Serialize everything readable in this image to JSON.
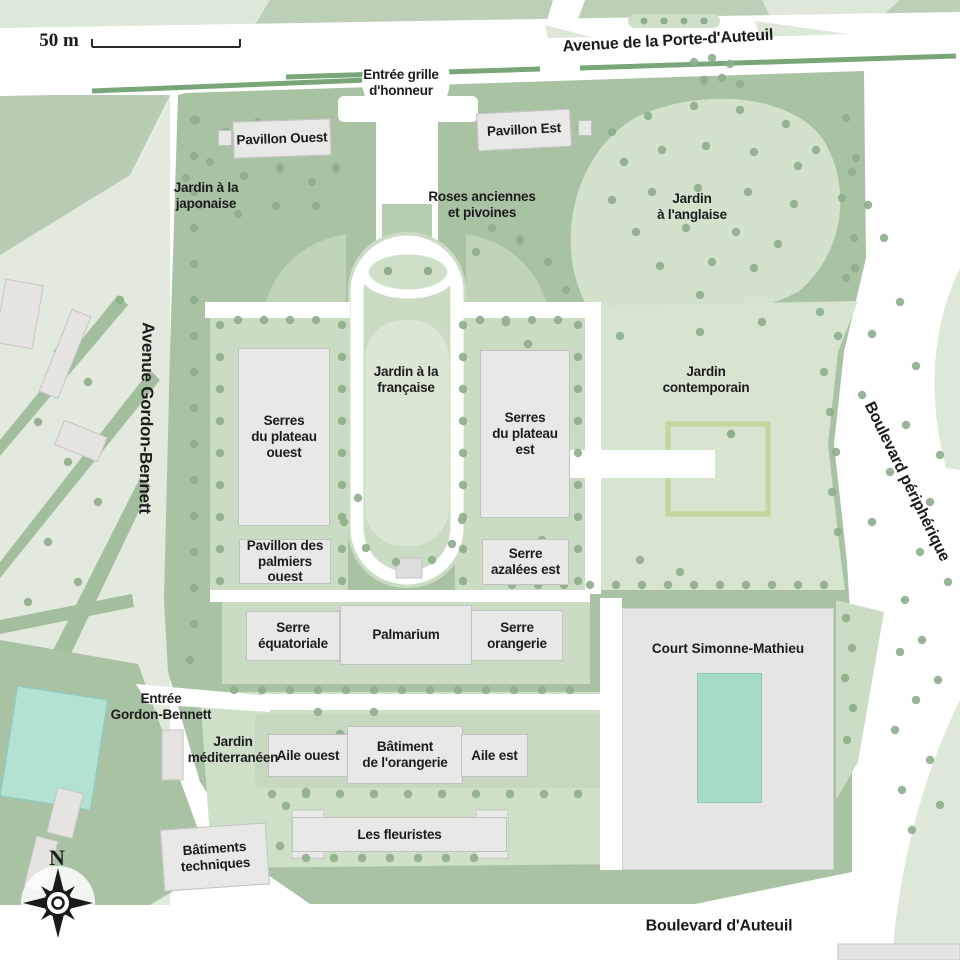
{
  "map": {
    "scale_label": "50 m",
    "compass_north": "N",
    "streets": {
      "porte_auteuil": "Avenue de la Porte-d'Auteuil",
      "gordon_bennett": "Avenue Gordon-Bennett",
      "peripherique": "Boulevard périphérique",
      "auteuil": "Boulevard d'Auteuil"
    },
    "entrances": {
      "grille_honneur": "Entrée grille\nd'honneur",
      "gordon_bennett": "Entrée\nGordon-Bennett"
    },
    "gardens": {
      "japonaise": "Jardin à la\njaponaise",
      "roses": "Roses anciennes\net pivoines",
      "anglaise": "Jardin\nà l'anglaise",
      "francaise": "Jardin à la\nfrançaise",
      "contemporain": "Jardin\ncontemporain",
      "mediterraneen": "Jardin\nméditerranéen"
    },
    "buildings": {
      "pavillon_ouest": "Pavillon Ouest",
      "pavillon_est": "Pavillon Est",
      "serres_plateau_ouest": "Serres\ndu plateau\nouest",
      "serres_plateau_est": "Serres\ndu plateau\nest",
      "pavillon_palmiers_ouest": "Pavillon des\npalmiers ouest",
      "serre_azalees_est": "Serre\nazalées est",
      "serre_equatoriale": "Serre\néquatoriale",
      "palmarium": "Palmarium",
      "serre_orangerie": "Serre\norangerie",
      "court_simonne_mathieu": "Court Simonne-Mathieu",
      "aile_ouest": "Aile ouest",
      "batiment_orangerie": "Bâtiment\nde l'orangerie",
      "aile_est": "Aile est",
      "les_fleuristes": "Les fleuristes",
      "batiments_techniques": "Bâtiments\ntechniques"
    },
    "colors": {
      "road_white": "#ffffff",
      "garden_dark_green": "#a9c2a4",
      "garden_light_green": "#d6e4d0",
      "pedestal_green": "#cbdcc5",
      "pale_green": "#e1eadc",
      "tree_dot_green": "#8fae8c",
      "building_gray": "#e8e8e6",
      "court_teal": "#a6dcc6",
      "pool_teal": "#b3e2d3",
      "hedge_green": "#c3d69b",
      "text": "#1c1c1c"
    }
  }
}
